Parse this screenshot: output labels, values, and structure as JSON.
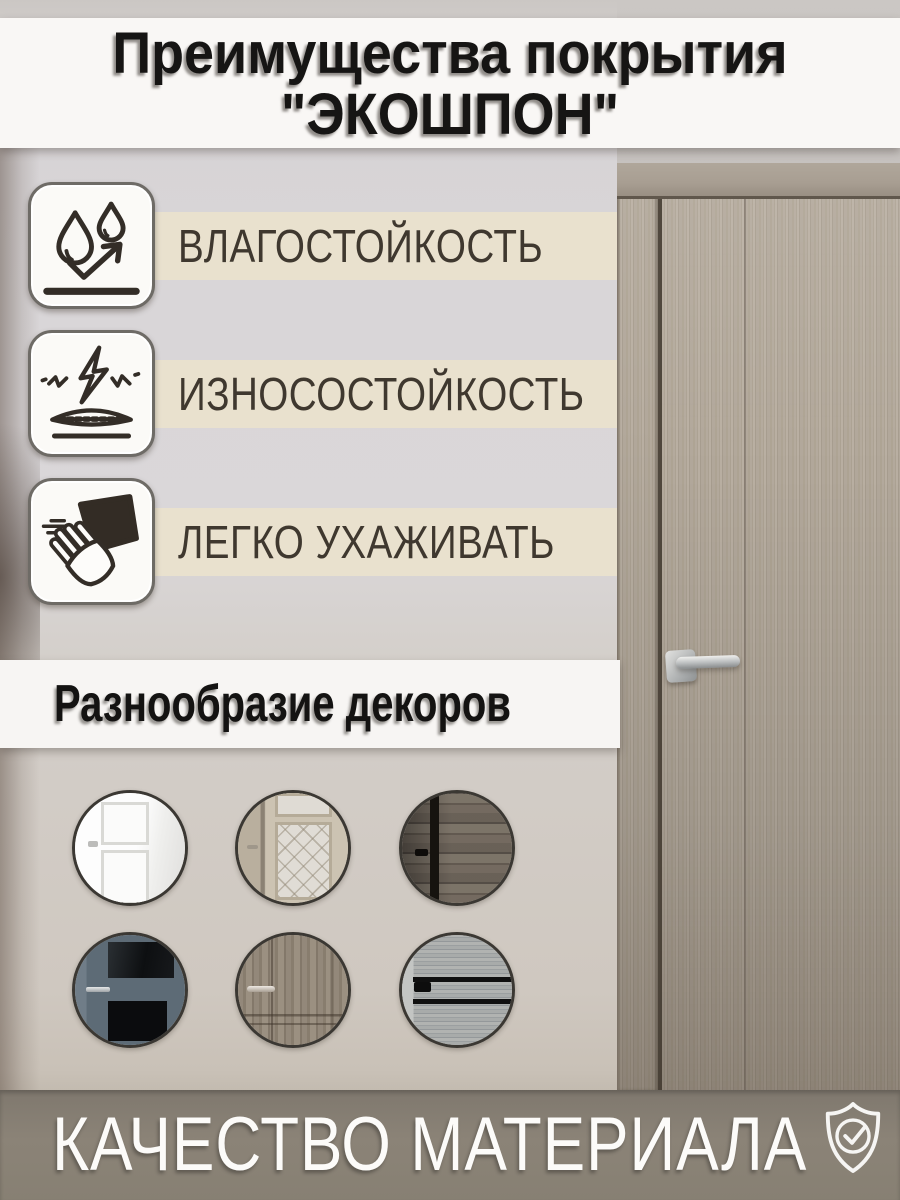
{
  "header": {
    "line1": "Преимущества покрытия",
    "line2": "\"ЭКОШПОН\""
  },
  "features": [
    {
      "name": "moisture-resistance",
      "icon": "water-drops-icon",
      "label": "ВЛАГОСТОЙКОСТЬ"
    },
    {
      "name": "wear-resistance",
      "icon": "impact-protection-icon",
      "label": "ИЗНОСОСТОЙКОСТЬ"
    },
    {
      "name": "easy-care",
      "icon": "wiping-hand-icon",
      "label": "ЛЕГКО УХАЖИВАТЬ"
    }
  ],
  "decors": {
    "title": "Разнообразие декоров",
    "items": [
      {
        "name": "white-classic-panel-door"
      },
      {
        "name": "beige-door-patterned-glass"
      },
      {
        "name": "dark-rustic-wood-decor"
      },
      {
        "name": "blue-gray-door-dark-glass"
      },
      {
        "name": "taupe-wood-panel-door"
      },
      {
        "name": "light-gray-wood-black-inlays"
      }
    ]
  },
  "footer": {
    "label": "КАЧЕСТВО МАТЕРИАЛА",
    "icon": "quality-shield-icon"
  },
  "colors": {
    "stripe_beige": "#e9e1cd",
    "banner_white": "#f9f7f5",
    "footer_taupe": "#867e73",
    "text_dark": "#3f382f",
    "icon_line": "#332d27",
    "door_wood": "#b0a699"
  }
}
